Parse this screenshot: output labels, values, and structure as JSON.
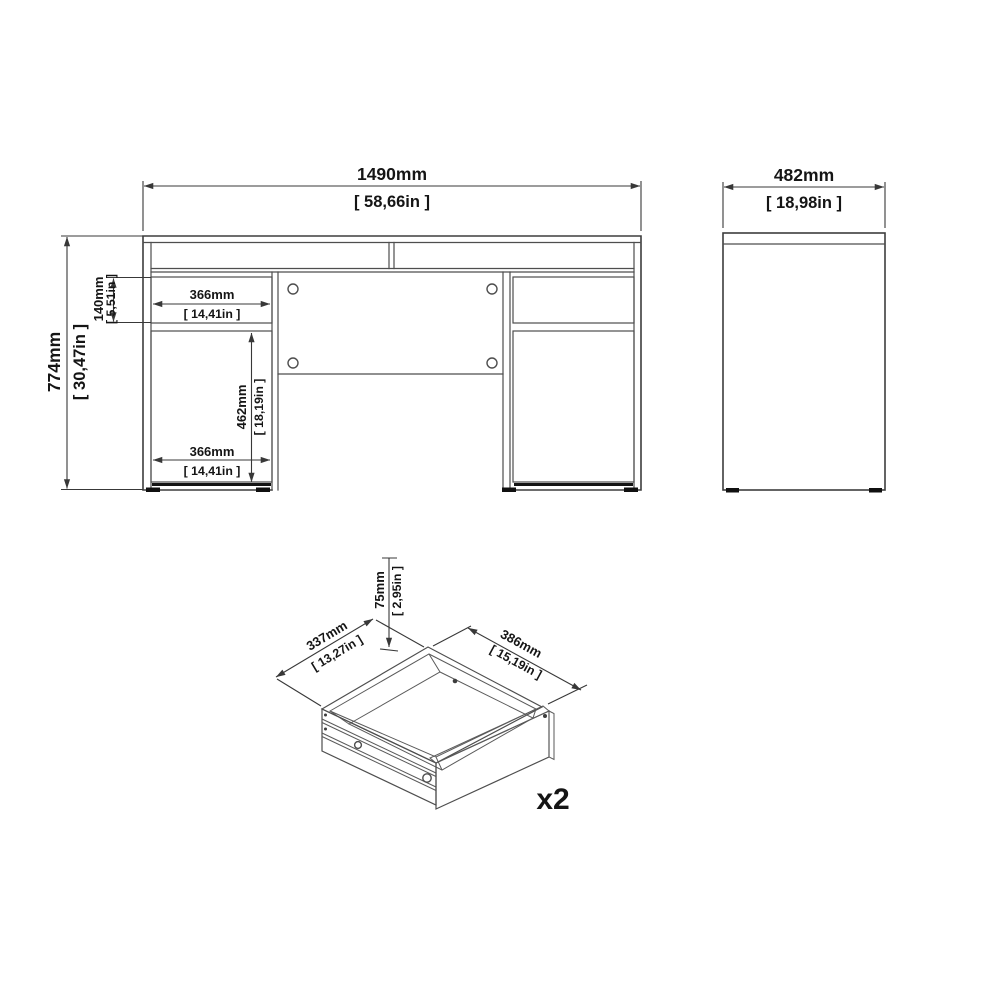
{
  "page": {
    "background": "#ffffff",
    "line_color": "#4e4e4e",
    "text_color": "#151515"
  },
  "front_view": {
    "width": {
      "mm": "1490mm",
      "in": "[ 58,66in ]"
    },
    "height": {
      "mm": "774mm",
      "in": "[ 30,47in ]"
    },
    "top_drawer_height": {
      "mm": "140mm",
      "in": "[ 5,51in ]"
    },
    "top_drawer_width": {
      "mm": "366mm",
      "in": "[ 14,41in ]"
    },
    "door_height": {
      "mm": "462mm",
      "in": "[ 18,19in ]"
    },
    "door_width": {
      "mm": "366mm",
      "in": "[ 14,41in ]"
    }
  },
  "side_view": {
    "depth": {
      "mm": "482mm",
      "in": "[ 18,98in ]"
    }
  },
  "drawer_detail": {
    "height": {
      "mm": "75mm",
      "in": "[ 2,95in ]"
    },
    "depth": {
      "mm": "337mm",
      "in": "[ 13,27in ]"
    },
    "width": {
      "mm": "386mm",
      "in": "[ 15,19in ]"
    },
    "quantity": "x2"
  }
}
